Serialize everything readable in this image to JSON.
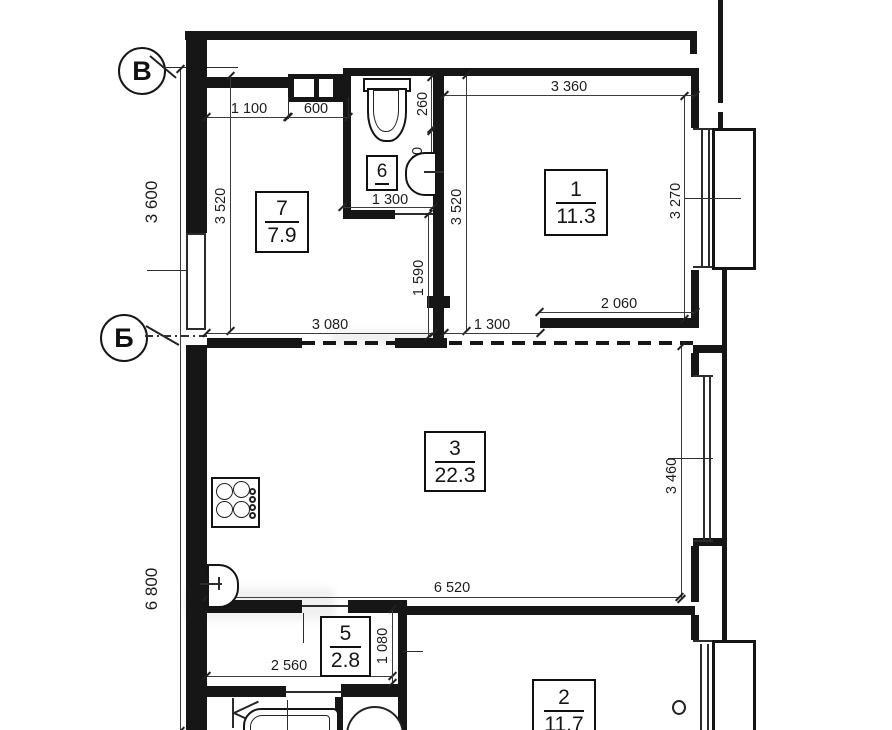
{
  "drawing": {
    "type": "apartment floor plan",
    "axis_markers": {
      "top": "В",
      "middle": "Б"
    },
    "left_dimensions": {
      "upper": "3 600",
      "lower": "6 800"
    },
    "rooms": {
      "room1": {
        "number": "1",
        "area": "11.3"
      },
      "room2": {
        "number": "2",
        "area": "11.7"
      },
      "room3": {
        "number": "3",
        "area": "22.3"
      },
      "room5": {
        "number": "5",
        "area": "2.8"
      },
      "room6": {
        "number": "6"
      },
      "room7": {
        "number": "7",
        "area": "7.9"
      }
    },
    "dimensions": {
      "d1100": "1 100",
      "d600": "600",
      "d3360": "3 360",
      "d3520_room7": "3 520",
      "d3520_room1": "3 520",
      "d3270": "3 270",
      "d260": "260",
      "d650": "650",
      "d1300_bath": "1 300",
      "d1300_door": "1 300",
      "d2060": "2 060",
      "d3080": "3 080",
      "d1590": "1 590",
      "d3460": "3 460",
      "d6520": "6 520",
      "d2560": "2 560",
      "d1080": "1 080"
    }
  }
}
